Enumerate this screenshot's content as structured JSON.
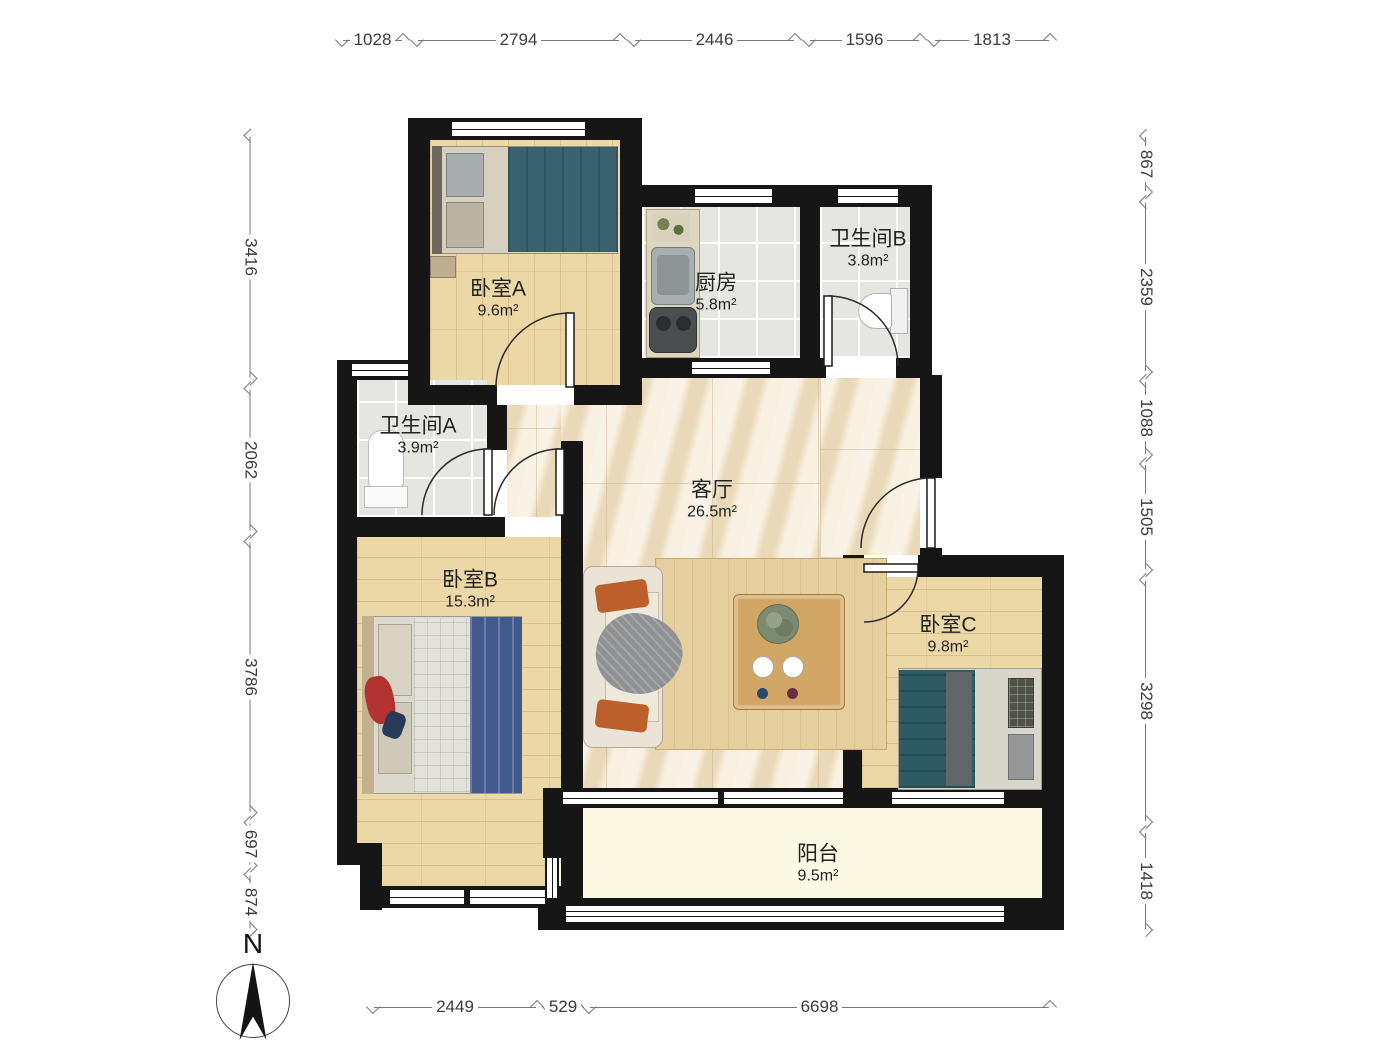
{
  "compass": {
    "label": "N"
  },
  "rooms": {
    "bedroomA": {
      "name": "卧室A",
      "area": "9.6m²"
    },
    "kitchen": {
      "name": "厨房",
      "area": "5.8m²"
    },
    "bathroomB": {
      "name": "卫生间B",
      "area": "3.8m²"
    },
    "bathroomA": {
      "name": "卫生间A",
      "area": "3.9m²"
    },
    "living": {
      "name": "客厅",
      "area": "26.5m²"
    },
    "bedroomB": {
      "name": "卧室B",
      "area": "15.3m²"
    },
    "bedroomC": {
      "name": "卧室C",
      "area": "9.8m²"
    },
    "balcony": {
      "name": "阳台",
      "area": "9.5m²"
    }
  },
  "dims": {
    "top": [
      "1028",
      "2794",
      "2446",
      "1596",
      "1813"
    ],
    "left": [
      "3416",
      "2062",
      "3786",
      "697",
      "874"
    ],
    "right": [
      "867",
      "2359",
      "1088",
      "1505",
      "3298",
      "1418"
    ],
    "bottom": [
      "2449",
      "529",
      "6698"
    ]
  }
}
